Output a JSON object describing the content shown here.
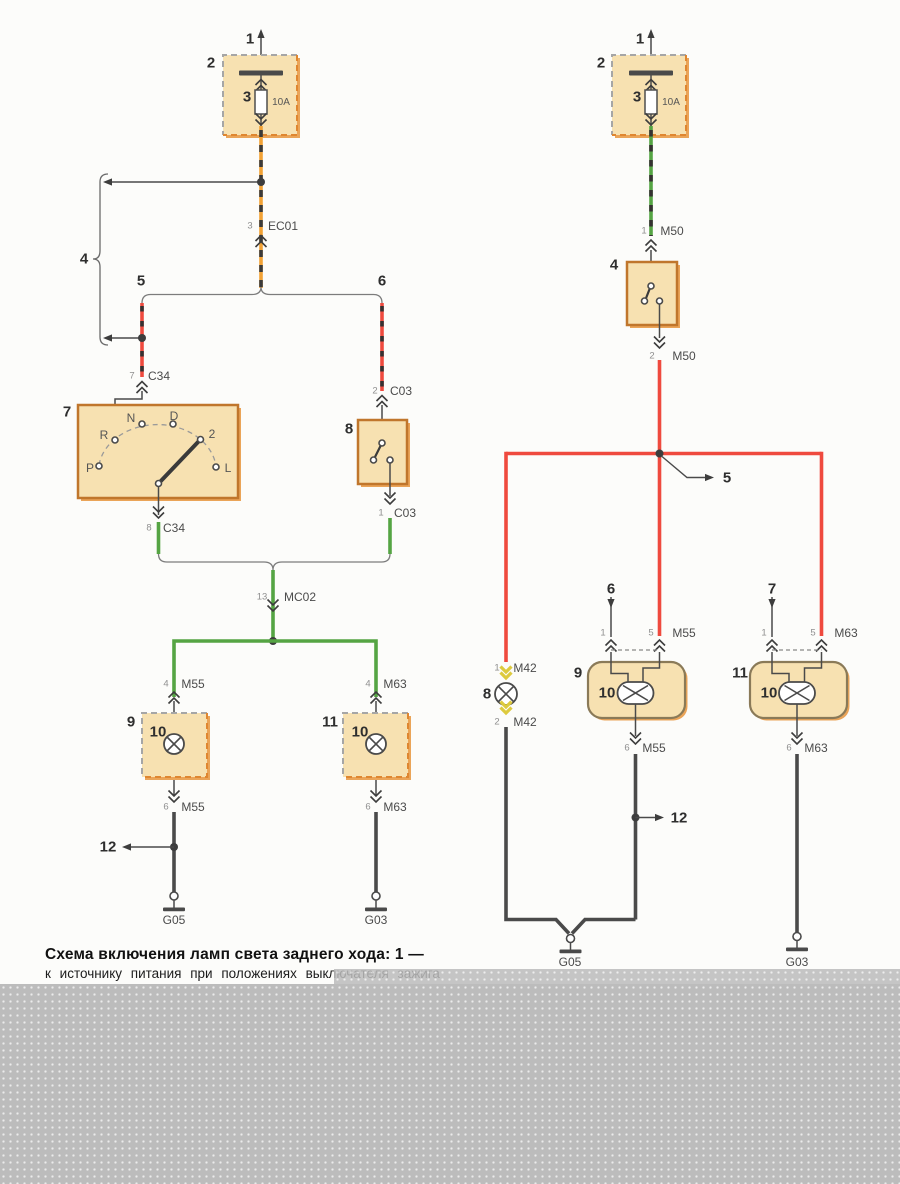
{
  "caption": {
    "line1": "Схема включения ламп света заднего хода: 1 —",
    "line2": "к источнику питания при положениях выключателя зажига"
  },
  "colors": {
    "wireRed": "#ef4a3e",
    "wireGreen": "#55a443",
    "wireOrange": "#f2a235",
    "wireDark": "#4a4a4a",
    "boxFill": "#f7e1b1",
    "boxBorder": "#c0762c",
    "boxRoundBorder": "#8a7a58",
    "boxShadow": "#eaa458",
    "dashGray": "#a6a6a6",
    "dashOrange": "#df8630",
    "connYellow": "#ddca3e",
    "grayBlock": "#bcbcbc"
  },
  "diagram": {
    "labels": [
      {
        "n": "left-power-1",
        "t": "1",
        "x": 250,
        "y": 39,
        "c": "num"
      },
      {
        "n": "left-fusebox-2",
        "t": "2",
        "x": 211,
        "y": 63,
        "c": "num"
      },
      {
        "n": "left-fuse-3",
        "t": "3",
        "x": 247,
        "y": 97,
        "c": "num"
      },
      {
        "n": "left-fuse-rating",
        "t": "10A",
        "x": 281,
        "y": 103,
        "c": "amp"
      },
      {
        "n": "left-ec01-pin3",
        "t": "3",
        "x": 250,
        "y": 226,
        "c": "pin"
      },
      {
        "n": "left-ec01-name",
        "t": "EC01",
        "x": 283,
        "y": 226,
        "c": "wirename"
      },
      {
        "n": "left-brace-4",
        "t": "4",
        "x": 84,
        "y": 259,
        "c": "num"
      },
      {
        "n": "left-branch-5",
        "t": "5",
        "x": 141,
        "y": 281,
        "c": "num"
      },
      {
        "n": "left-branch-6",
        "t": "6",
        "x": 382,
        "y": 281,
        "c": "num"
      },
      {
        "n": "left-c34-pin7",
        "t": "7",
        "x": 132,
        "y": 376,
        "c": "pin"
      },
      {
        "n": "left-c34-top-name",
        "t": "C34",
        "x": 159,
        "y": 376,
        "c": "wirename"
      },
      {
        "n": "left-selector-7",
        "t": "7",
        "x": 67,
        "y": 412,
        "c": "num"
      },
      {
        "n": "selector-pos-p",
        "t": "P",
        "x": 90,
        "y": 468,
        "c": "pos"
      },
      {
        "n": "selector-pos-r",
        "t": "R",
        "x": 104,
        "y": 435,
        "c": "pos"
      },
      {
        "n": "selector-pos-n",
        "t": "N",
        "x": 131,
        "y": 418,
        "c": "pos"
      },
      {
        "n": "selector-pos-d",
        "t": "D",
        "x": 174,
        "y": 416,
        "c": "pos"
      },
      {
        "n": "selector-pos-2",
        "t": "2",
        "x": 212,
        "y": 434,
        "c": "pos"
      },
      {
        "n": "selector-pos-l",
        "t": "L",
        "x": 228,
        "y": 468,
        "c": "pos"
      },
      {
        "n": "left-c34-pin8",
        "t": "8",
        "x": 149,
        "y": 528,
        "c": "pin"
      },
      {
        "n": "left-c34-bottom-name",
        "t": "C34",
        "x": 174,
        "y": 528,
        "c": "wirename"
      },
      {
        "n": "left-c03-pin2",
        "t": "2",
        "x": 375,
        "y": 391,
        "c": "pin"
      },
      {
        "n": "left-c03-top-name",
        "t": "C03",
        "x": 401,
        "y": 391,
        "c": "wirename"
      },
      {
        "n": "left-switch-8",
        "t": "8",
        "x": 349,
        "y": 429,
        "c": "num"
      },
      {
        "n": "left-c03-pin1",
        "t": "1",
        "x": 381,
        "y": 513,
        "c": "pin"
      },
      {
        "n": "left-c03-bottom-name",
        "t": "C03",
        "x": 405,
        "y": 513,
        "c": "wirename"
      },
      {
        "n": "left-mc02-pin13",
        "t": "13",
        "x": 262,
        "y": 597,
        "c": "pin"
      },
      {
        "n": "left-mc02-name",
        "t": "MC02",
        "x": 300,
        "y": 597,
        "c": "wirename"
      },
      {
        "n": "left-m55-pin4",
        "t": "4",
        "x": 166,
        "y": 684,
        "c": "pin"
      },
      {
        "n": "left-m55-top-name",
        "t": "M55",
        "x": 193,
        "y": 684,
        "c": "wirename"
      },
      {
        "n": "left-m63-pin4",
        "t": "4",
        "x": 368,
        "y": 684,
        "c": "pin"
      },
      {
        "n": "left-m63-top-name",
        "t": "M63",
        "x": 395,
        "y": 684,
        "c": "wirename"
      },
      {
        "n": "left-lamp-9",
        "t": "9",
        "x": 131,
        "y": 722,
        "c": "num"
      },
      {
        "n": "left-lamp-9-bulb-10",
        "t": "10",
        "x": 158,
        "y": 732,
        "c": "num"
      },
      {
        "n": "left-lamp-11",
        "t": "11",
        "x": 330,
        "y": 722,
        "c": "num"
      },
      {
        "n": "left-lamp-11-bulb-10",
        "t": "10",
        "x": 360,
        "y": 732,
        "c": "num"
      },
      {
        "n": "left-m55-pin6",
        "t": "6",
        "x": 166,
        "y": 807,
        "c": "pin"
      },
      {
        "n": "left-m55-bottom-name",
        "t": "M55",
        "x": 193,
        "y": 807,
        "c": "wirename"
      },
      {
        "n": "left-m63-pin6",
        "t": "6",
        "x": 368,
        "y": 807,
        "c": "pin"
      },
      {
        "n": "left-m63-bottom-name",
        "t": "M63",
        "x": 395,
        "y": 807,
        "c": "wirename"
      },
      {
        "n": "left-junction-12",
        "t": "12",
        "x": 108,
        "y": 847,
        "c": "num"
      },
      {
        "n": "left-ground-g05",
        "t": "G05",
        "x": 174,
        "y": 920,
        "c": "gnd"
      },
      {
        "n": "left-ground-g03",
        "t": "G03",
        "x": 376,
        "y": 920,
        "c": "gnd"
      },
      {
        "n": "right-power-1",
        "t": "1",
        "x": 640,
        "y": 39,
        "c": "num"
      },
      {
        "n": "right-fusebox-2",
        "t": "2",
        "x": 601,
        "y": 63,
        "c": "num"
      },
      {
        "n": "right-fuse-3",
        "t": "3",
        "x": 637,
        "y": 97,
        "c": "num"
      },
      {
        "n": "right-fuse-rating",
        "t": "10A",
        "x": 671,
        "y": 103,
        "c": "amp"
      },
      {
        "n": "right-m50-pin1",
        "t": "1",
        "x": 644,
        "y": 231,
        "c": "pin"
      },
      {
        "n": "right-m50-top-name",
        "t": "M50",
        "x": 672,
        "y": 231,
        "c": "wirename"
      },
      {
        "n": "right-switch-4",
        "t": "4",
        "x": 614,
        "y": 265,
        "c": "num"
      },
      {
        "n": "right-m50-pin2",
        "t": "2",
        "x": 652,
        "y": 356,
        "c": "pin"
      },
      {
        "n": "right-m50-bottom-name",
        "t": "M50",
        "x": 684,
        "y": 356,
        "c": "wirename"
      },
      {
        "n": "right-junction-5",
        "t": "5",
        "x": 727,
        "y": 478,
        "c": "num"
      },
      {
        "n": "right-branch-6",
        "t": "6",
        "x": 611,
        "y": 589,
        "c": "num"
      },
      {
        "n": "right-branch-7",
        "t": "7",
        "x": 772,
        "y": 589,
        "c": "num"
      },
      {
        "n": "right-m55-pin1",
        "t": "1",
        "x": 603,
        "y": 633,
        "c": "pin"
      },
      {
        "n": "right-m55-pin5",
        "t": "5",
        "x": 651,
        "y": 633,
        "c": "pin"
      },
      {
        "n": "right-m55-name",
        "t": "M55",
        "x": 684,
        "y": 633,
        "c": "wirename"
      },
      {
        "n": "right-m63-pin1",
        "t": "1",
        "x": 764,
        "y": 633,
        "c": "pin"
      },
      {
        "n": "right-m63-pin5",
        "t": "5",
        "x": 813,
        "y": 633,
        "c": "pin"
      },
      {
        "n": "right-m63-name",
        "t": "M63",
        "x": 846,
        "y": 633,
        "c": "wirename"
      },
      {
        "n": "right-m42-pin1",
        "t": "1",
        "x": 497,
        "y": 668,
        "c": "pin"
      },
      {
        "n": "right-m42-top-name",
        "t": "M42",
        "x": 525,
        "y": 668,
        "c": "wirename"
      },
      {
        "n": "right-lamp-8",
        "t": "8",
        "x": 487,
        "y": 694,
        "c": "num"
      },
      {
        "n": "right-m42-pin2",
        "t": "2",
        "x": 497,
        "y": 722,
        "c": "pin"
      },
      {
        "n": "right-m42-bottom-name",
        "t": "M42",
        "x": 525,
        "y": 722,
        "c": "wirename"
      },
      {
        "n": "right-lamp-9",
        "t": "9",
        "x": 578,
        "y": 673,
        "c": "num"
      },
      {
        "n": "right-lamp-9-bulb-10",
        "t": "10",
        "x": 607,
        "y": 693,
        "c": "num"
      },
      {
        "n": "right-lamp-11",
        "t": "11",
        "x": 740,
        "y": 673,
        "c": "num"
      },
      {
        "n": "right-lamp-11-bulb-10",
        "t": "10",
        "x": 769,
        "y": 693,
        "c": "num"
      },
      {
        "n": "right-m55-pin6",
        "t": "6",
        "x": 627,
        "y": 748,
        "c": "pin"
      },
      {
        "n": "right-m55-bottom-name",
        "t": "M55",
        "x": 654,
        "y": 748,
        "c": "wirename"
      },
      {
        "n": "right-m63-pin6",
        "t": "6",
        "x": 789,
        "y": 748,
        "c": "pin"
      },
      {
        "n": "right-m63-bottom-name",
        "t": "M63",
        "x": 816,
        "y": 748,
        "c": "wirename"
      },
      {
        "n": "right-junction-12",
        "t": "12",
        "x": 679,
        "y": 818,
        "c": "num"
      },
      {
        "n": "right-ground-g05",
        "t": "G05",
        "x": 570,
        "y": 962,
        "c": "gnd"
      },
      {
        "n": "right-ground-g03",
        "t": "G03",
        "x": 797,
        "y": 962,
        "c": "gnd"
      }
    ]
  }
}
